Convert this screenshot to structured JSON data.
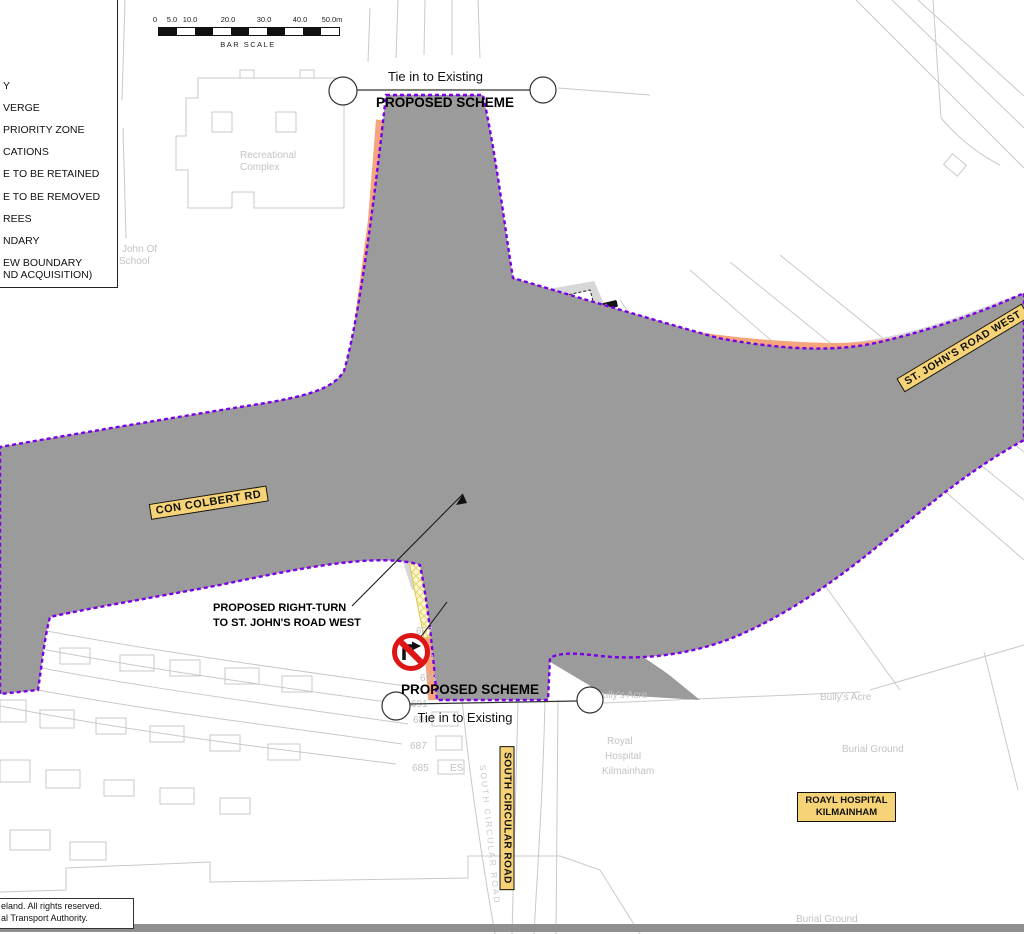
{
  "colors": {
    "boundary_purple": "#7A00E6",
    "footpath_salmon": "#F4A57E",
    "cycle_blue": "#7B9DEF",
    "verge_green": "#9FE556",
    "bus_magenta": "#EE00EE",
    "road_gray": "#D7D7D7",
    "verge_gray": "#9B9B9B",
    "hatch_yellow": "#FBF7CF",
    "label_yellow": "#F6D377",
    "sign_red": "#DD1515"
  },
  "legend": {
    "items": [
      "Y",
      "VERGE",
      "PRIORITY ZONE",
      "CATIONS",
      "E TO BE RETAINED",
      "E TO BE REMOVED",
      "REES",
      "NDARY",
      "EW BOUNDARY",
      "ND ACQUISITION)"
    ]
  },
  "bar_scale": {
    "ticks": [
      "0",
      "5.0",
      "10.0",
      "20.0",
      "30.0",
      "40.0",
      "50.0m"
    ],
    "caption": "BAR SCALE"
  },
  "tie_in_top": {
    "existing": "Tie in to Existing",
    "scheme": "PROPOSED SCHEME"
  },
  "tie_in_bottom": {
    "scheme": "PROPOSED SCHEME",
    "existing": "Tie in to Existing"
  },
  "road_labels": {
    "con_colbert": "CON COLBERT RD",
    "st_johns": "ST. JOHN'S ROAD WEST",
    "south_circular": "SOUTH CIRCULAR ROAD"
  },
  "hospital_box": {
    "line1": "ROAYL HOSPITAL",
    "line2": "KILMAINHAM"
  },
  "annotation": {
    "line1": "PROPOSED RIGHT-TURN",
    "line2": "TO ST. JOHN'S ROAD WEST"
  },
  "map_labels": {
    "recreational_line1": "Recreational",
    "recreational_line2": "Complex",
    "school_line1": "John Of",
    "school_line2": "School",
    "bullys_acre_left": "Bully's Acre",
    "bullys_acre_right": "Bully's Acre",
    "royal": "Royal",
    "hospital": "Hospital",
    "kilmainham": "Kilmainham",
    "burial_ground_mid": "Burial Ground",
    "burial_ground_bottom": "Burial Ground",
    "south_circular_existing": "SOUTH CIRCULAR ROAD",
    "es_fragment": "ES"
  },
  "house_numbers": [
    "697",
    "695",
    "693",
    "691",
    "689",
    "687",
    "685"
  ],
  "footer": {
    "line1": "eland. All rights reserved.",
    "line2": "al Transport Authority."
  }
}
